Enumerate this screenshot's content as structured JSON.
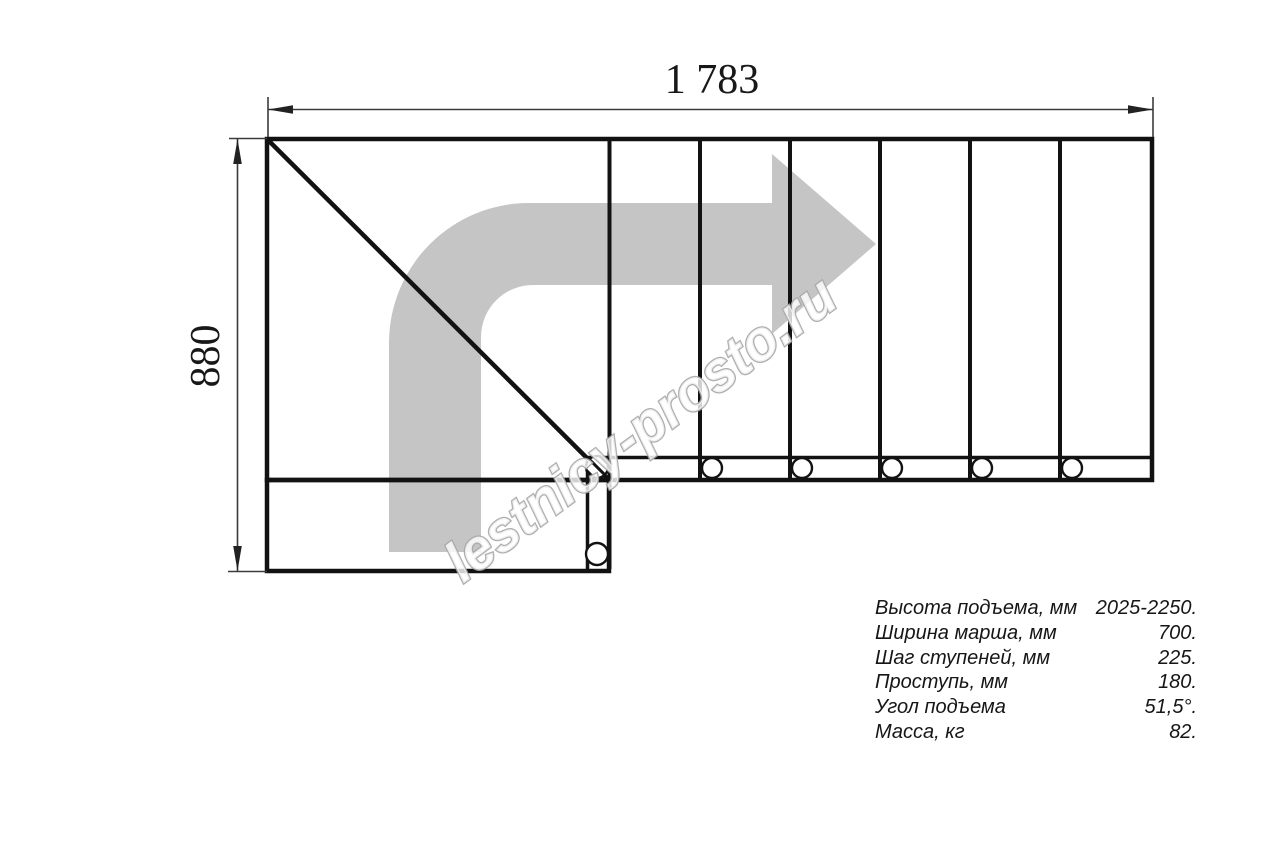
{
  "drawing": {
    "width_dimension": "1 783",
    "height_dimension": "880",
    "watermark": "lestnicy-prosto.ru",
    "colors": {
      "outline": "#121212",
      "dimension": "#3c3c3c",
      "arrow": "#c5c5c5",
      "watermark_outline": "#a6a6a6"
    }
  },
  "specs": {
    "rows": [
      {
        "label": "Высота подъема, мм",
        "value": "2025-2250."
      },
      {
        "label": "Ширина марша, мм",
        "value": "700."
      },
      {
        "label": "Шаг ступеней, мм",
        "value": "225."
      },
      {
        "label": "Проступь, мм",
        "value": "180."
      },
      {
        "label": "Угол подъема",
        "value": "51,5°."
      },
      {
        "label": "Масса, кг",
        "value": "82."
      }
    ]
  }
}
